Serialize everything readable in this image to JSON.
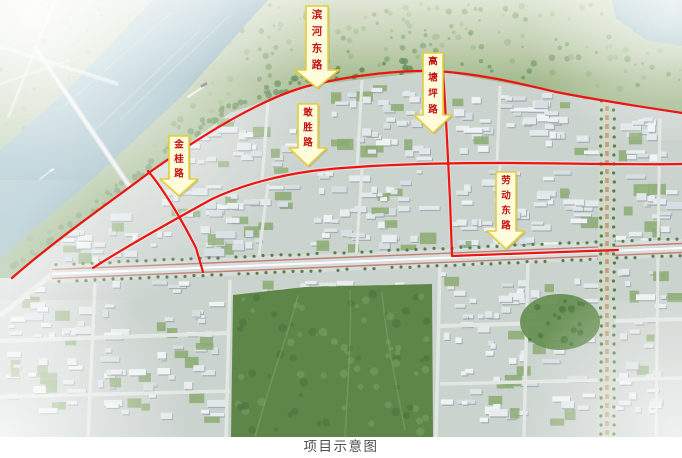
{
  "annotations": {
    "road_labels": [
      {
        "text": "滨河东路"
      },
      {
        "text": "高塘坪路"
      },
      {
        "text": "敢胜路"
      },
      {
        "text": "金桂路"
      },
      {
        "text": "劳动东路"
      }
    ],
    "colors": {
      "highlight_line": "#ee1411",
      "arrow_fill": "#fffcdb",
      "arrow_border": "#e2ce38",
      "label_text": "#c31212"
    }
  },
  "caption": {
    "text": "项目示意图"
  }
}
